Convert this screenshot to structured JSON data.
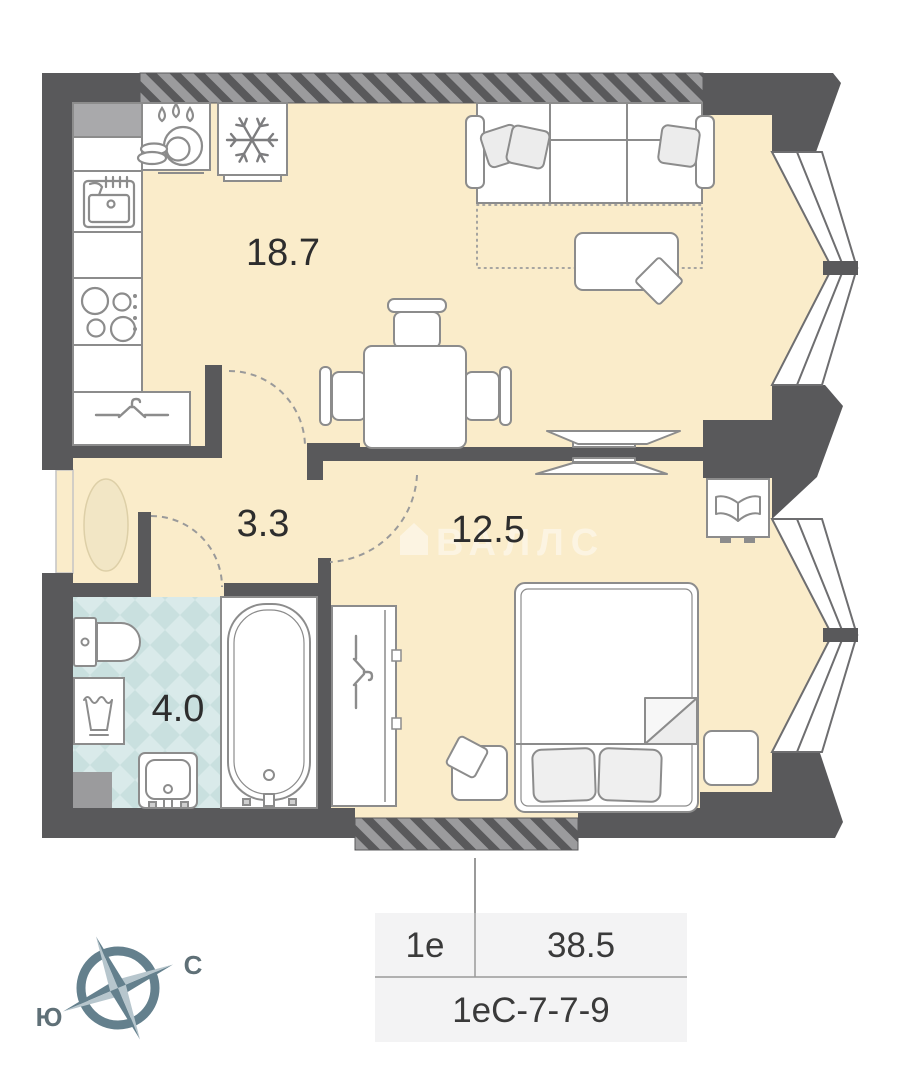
{
  "plan": {
    "rooms": [
      {
        "name": "kitchen-living-room",
        "area": "18.7"
      },
      {
        "name": "hallway",
        "area": "3.3"
      },
      {
        "name": "bedroom",
        "area": "12.5"
      },
      {
        "name": "bathroom",
        "area": "4.0"
      }
    ],
    "compass": {
      "north": "С",
      "south": "Ю"
    },
    "watermark": "ВАЛЛС"
  },
  "info_table": {
    "type": "1е",
    "total_area": "38.5",
    "code": "1еС-7-7-9"
  },
  "colors": {
    "floor": "#faecca",
    "wall": "#59595b",
    "wall_light": "#9b9b9d",
    "tile_base": "#d9eaea",
    "tile_diamond": "#c9e0df",
    "furniture_stroke": "#8c8c8c",
    "rug": "#f2e6c5",
    "compass_dark": "#64808d",
    "compass_light": "#b7c6cd",
    "table_bg": "#f3f3f4",
    "label_text": "#2d2d2d"
  }
}
